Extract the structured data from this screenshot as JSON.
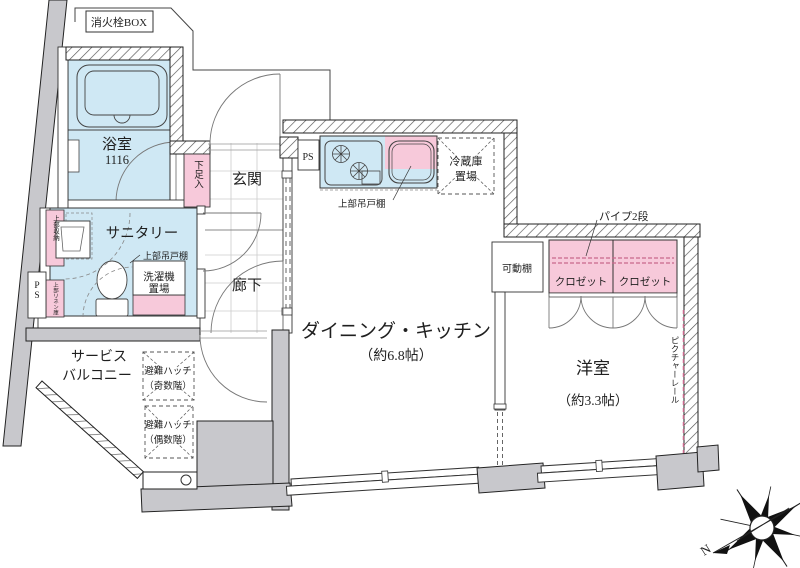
{
  "document_type": "apartment-floor-plan",
  "colors": {
    "room_blue": "#cfe8f4",
    "fixture_pink": "#f7c9da",
    "slab_gray": "#c8c8cc",
    "line_black": "#222222",
    "pipe_pink": "#c9688c"
  },
  "labels": {
    "fire_box": "消火栓BOX",
    "bath": "浴室",
    "bath_size": "1116",
    "shoe_box": "下足入",
    "entrance": "玄関",
    "corridor": "廊下",
    "sanitary": "サニタリー",
    "upper_storage": "上部収納",
    "upper_linen": "上部リネン庫",
    "ps": "PS",
    "upper_cabinet": "上部吊戸棚",
    "washer_l1": "洗濯機",
    "washer_l2": "置場",
    "fridge_l1": "冷蔵庫",
    "fridge_l2": "置場",
    "dk": "ダイニング・キッチン",
    "dk_size": "（約6.8帖）",
    "pipe": "パイプ2段",
    "shelf": "可動棚",
    "closet": "クロゼット",
    "western": "洋室",
    "western_size": "（約3.3帖）",
    "picture_rail": "ピクチャーレール",
    "balcony_l1": "サービス",
    "balcony_l2": "バルコニー",
    "hatch_title": "避難ハッチ",
    "hatch_odd": "（奇数階）",
    "hatch_even": "（偶数階）",
    "north": "N"
  }
}
